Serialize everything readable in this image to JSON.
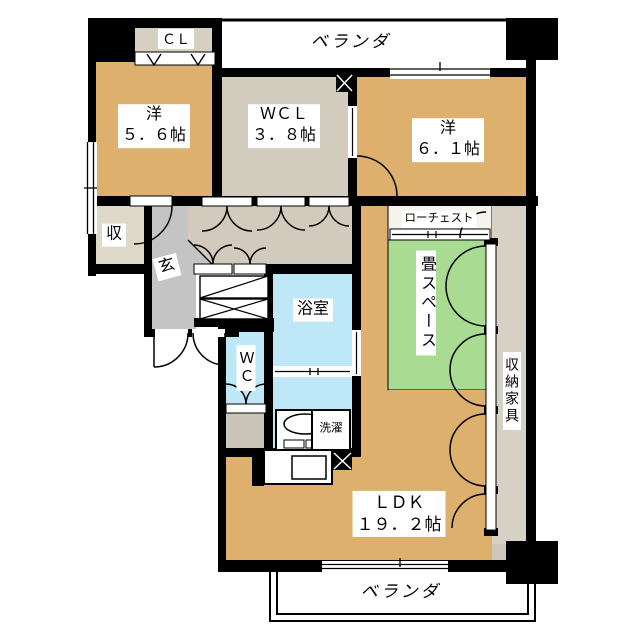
{
  "title": "マンション間取り図",
  "colors": {
    "wall": "#000000",
    "room_tan": "#DDB06E",
    "closet_beige": "#D6D0C1",
    "wcl_beige": "#D2CCBE",
    "hall_beige": "#D2CBBD",
    "storage_beige": "#DFD9C9",
    "entrance_gray": "#C4C4C4",
    "wet_blue": "#BEE8F7",
    "tatami_green": "#A9DC92",
    "storage_strip": "#D5D1C5",
    "under_wc_gray": "#CBC5B9",
    "lowchest_white": "#F6F3EC",
    "white": "#FFFFFF"
  },
  "labels": {
    "veranda_top": "ベランダ",
    "veranda_bottom": "ベランダ",
    "closet": "ＣＬ",
    "western_room_1": {
      "name": "洋",
      "size": "５．６帖"
    },
    "walk_in_closet": {
      "name": "ＷＣＬ",
      "size": "３．８帖"
    },
    "western_room_2": {
      "name": "洋",
      "size": "６．１帖"
    },
    "storage_small": "収",
    "entrance": "玄",
    "bathroom": "浴室",
    "toilet": "ＷＣ",
    "laundry": "洗濯",
    "low_chest": "ローチェスト",
    "tatami_space": "畳スペース",
    "storage_furniture": "収納家具",
    "ldk": {
      "name": "ＬＤＫ",
      "size": "１９．２帖"
    }
  }
}
